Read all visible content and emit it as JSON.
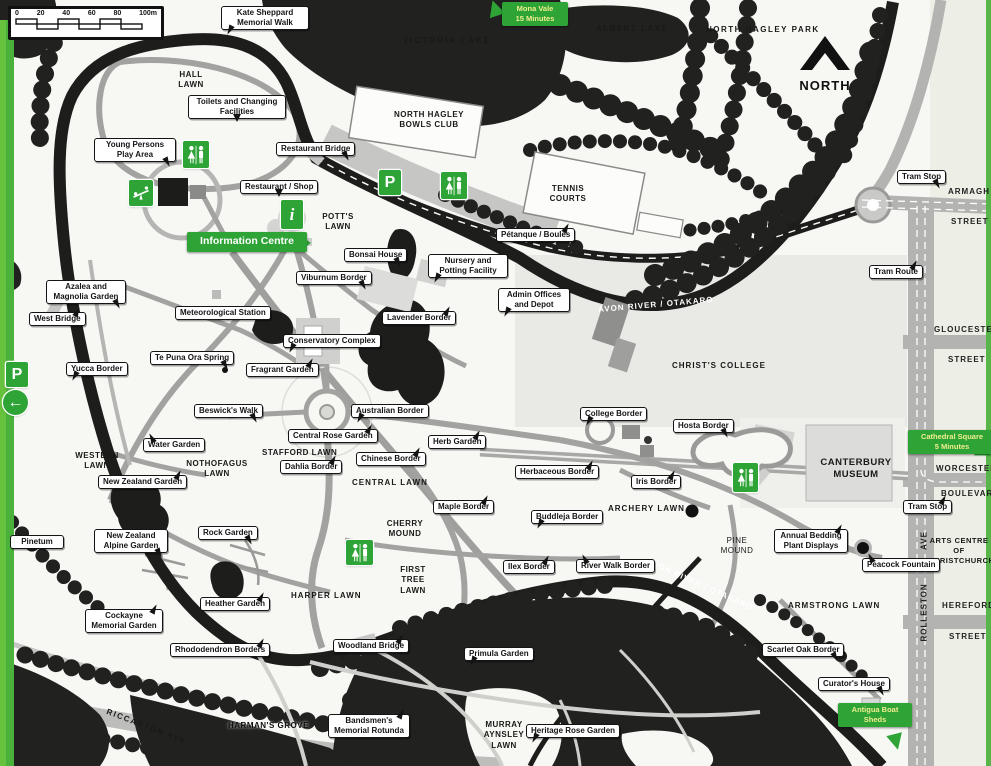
{
  "colors": {
    "accent_green": "#2ea336",
    "map_dark": "#21211f",
    "road_gray": "#a8a8a6",
    "pale_block": "#e9e9e6"
  },
  "scale_bar": {
    "ticks": [
      "0",
      "20",
      "40",
      "60",
      "80",
      "100m"
    ]
  },
  "compass": {
    "label": "NORTH"
  },
  "river_label": "AVON RIVER / OTAKARO",
  "signs": {
    "mona_vale": {
      "line1": "Mona Vale",
      "line2": "15 Minutes"
    },
    "information_centre": "Information Centre",
    "cathedral_square": {
      "line1": "Cathedral Square",
      "line2": "5 Minutes"
    },
    "antigua_boat_sheds": {
      "line1": "Antigua Boat",
      "line2": "Sheds"
    },
    "parking": "P",
    "information": "i",
    "left_arrow": "←"
  },
  "callouts": {
    "kate_sheppard": "Kate Sheppard Memorial Walk",
    "toilets_changing": "Toilets and Changing Facilities",
    "young_persons_play_area": "Young Persons Play Area",
    "restaurant_bridge": "Restaurant Bridge",
    "restaurant_shop": "Restaurant / Shop",
    "petanque_boules": "Pétanque / Boules",
    "bonsai_house": "Bonsai House",
    "nursery_potting": "Nursery and Potting Facility",
    "viburnum_border": "Viburnum Border",
    "admin_offices": "Admin Offices and Depot",
    "lavender_border": "Lavender Border",
    "azalea_magnolia": "Azalea and Magnolia Garden",
    "west_bridge": "West Bridge",
    "meteorological_station": "Meteorological Station",
    "conservatory_complex": "Conservatory Complex",
    "te_puna_ora_spring": "Te Puna Ora Spring",
    "fragrant_garden": "Fragrant Garden",
    "yucca_border": "Yucca Border",
    "beswicks_walk": "Beswick's Walk",
    "australian_border": "Australian Border",
    "central_rose_garden": "Central Rose Garden",
    "water_garden": "Water Garden",
    "herb_garden": "Herb Garden",
    "college_border": "College Border",
    "hosta_border": "Hosta Border",
    "chinese_border": "Chinese Border",
    "dahlia_border": "Dahlia Border",
    "herbaceous_border": "Herbaceous Border",
    "iris_border": "Iris Border",
    "new_zealand_garden": "New Zealand Garden",
    "maple_border": "Maple Border",
    "buddleja_border": "Buddleja Border",
    "new_zealand_alpine_garden": "New Zealand Alpine Garden",
    "rock_garden": "Rock Garden",
    "annual_bedding": "Annual Bedding Plant Displays",
    "peacock_fountain": "Peacock Fountain",
    "ilex_border": "Ilex Border",
    "river_walk_border": "River Walk Border",
    "heather_garden": "Heather Garden",
    "cockayne_memorial_garden": "Cockayne Memorial Garden",
    "rhododendron_borders": "Rhododendron Borders",
    "woodland_bridge": "Woodland Bridge",
    "primula_garden": "Primula Garden",
    "scarlet_oak_border": "Scarlet Oak Border",
    "curators_house": "Curator's House",
    "pinetum": "Pinetum",
    "heritage_rose_garden": "Heritage Rose Garden",
    "bandsmens_rotunda": "Bandsmen's Memorial Rotunda",
    "tram_stop": "Tram Stop",
    "tram_route": "Tram Route"
  },
  "areas": {
    "hall_lawn": "HALL LAWN",
    "victoria_lake": "VICTORIA LAKE",
    "albert_lake": "ALBERT LAKE",
    "north_hagley_park": "NORTH HAGLEY PARK",
    "bowls_club": "NORTH HAGLEY BOWLS CLUB",
    "tennis_courts": "TENNIS COURTS",
    "potts_lawn": "POTT'S LAWN",
    "christs_college": "CHRIST'S COLLEGE",
    "canterbury_museum": "CANTERBURY MUSEUM",
    "arts_centre": "ARTS CENTRE OF CHRISTCHURCH",
    "western_lawn": "WESTERN LAWN",
    "nothofagus_lawn": "NOTHOFAGUS LAWN",
    "stafford_lawn": "STAFFORD LAWN",
    "central_lawn": "CENTRAL LAWN",
    "cherry_mound": "CHERRY MOUND",
    "first_tree_lawn": "FIRST TREE LAWN",
    "harper_lawn": "HARPER LAWN",
    "archery_lawn": "ARCHERY LAWN",
    "pine_mound": "PINE MOUND",
    "armstrong_lawn": "ARMSTRONG LAWN",
    "murray_aynsley_lawn": "MURRAY AYNSLEY LAWN",
    "harmans_grove": "HARMAN'S GROVE"
  },
  "streets": {
    "armagh": "ARMAGH",
    "gloucester": "GLOUCESTER",
    "worcester": "WORCESTER",
    "boulevard": "BOULEVARD",
    "hereford": "HEREFORD",
    "street": "STREET",
    "rolleston": "ROLLESTON",
    "ave": "AVE",
    "riccarton_ave": "RICCARTON AVE"
  }
}
